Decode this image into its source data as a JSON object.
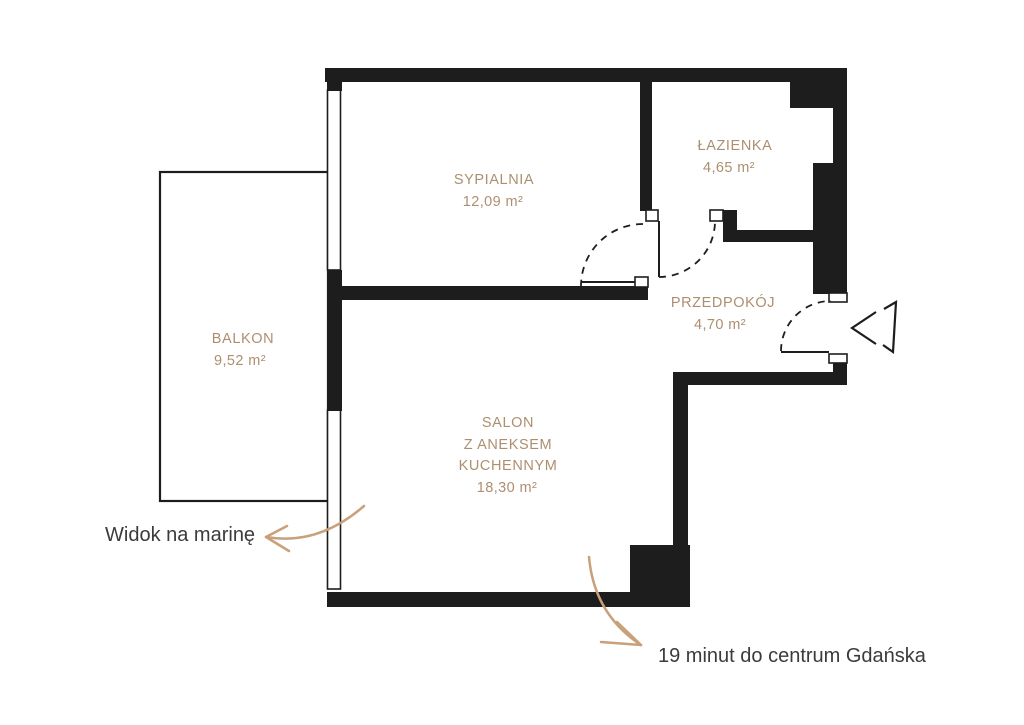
{
  "plan": {
    "rooms": [
      {
        "name": "SYPIALNIA",
        "area": "12,09 m²"
      },
      {
        "name": "ŁAZIENKA",
        "area": "4,65 m²"
      },
      {
        "name": "PRZEDPOKÓJ",
        "area": "4,70 m²"
      },
      {
        "name_lines": [
          "SALON",
          "Z ANEKSEM",
          "KUCHENNYM"
        ],
        "area": "18,30 m²"
      },
      {
        "name": "BALKON",
        "area": "9,52 m²"
      }
    ],
    "annotations": {
      "marina": "Widok na marinę",
      "gdansk": "19 minut do centrum Gdańska"
    },
    "colors": {
      "wall": "#1d1d1d",
      "room_label": "#ad8f6f",
      "accent_arrow": "#c8a079",
      "annotation_text": "#3b3b3b",
      "background": "#ffffff"
    }
  }
}
